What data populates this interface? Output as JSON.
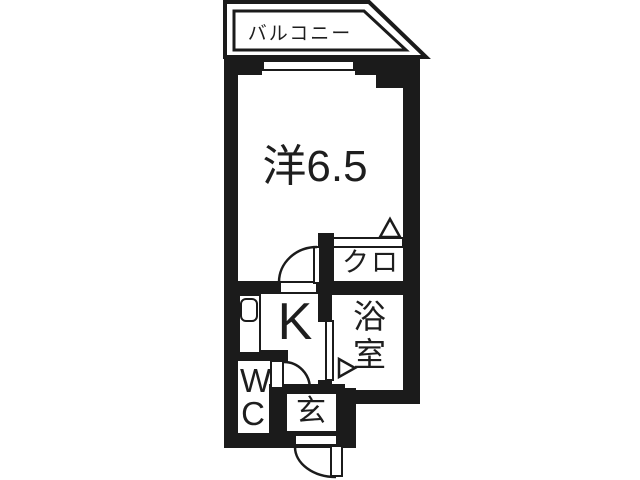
{
  "plan": {
    "type": "apartment-floor-plan",
    "rooms": {
      "balcony": {
        "label": "バルコニー"
      },
      "main_room": {
        "label": "洋6.5"
      },
      "closet": {
        "label": "クロ"
      },
      "kitchen": {
        "label": "K"
      },
      "bathroom": {
        "label": "浴室"
      },
      "toilet": {
        "label": "WC"
      },
      "entrance": {
        "label": "玄"
      }
    },
    "colors": {
      "wall": "#1b1b1b",
      "background": "#ffffff",
      "line": "#1b1b1b"
    }
  }
}
